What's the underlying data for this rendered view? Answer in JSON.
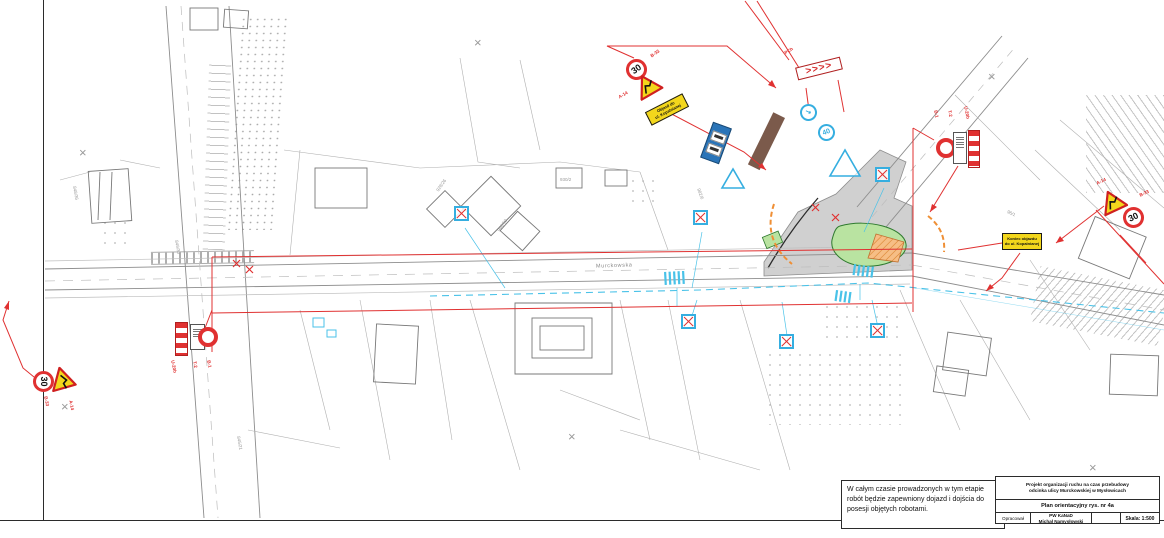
{
  "sheet": {
    "note": "W całym czasie prowadzonych w tym etapie robót będzie zapewniony dojazd i dojścia do posesji objętych robotami.",
    "title_block": {
      "project_title_line1": "Projekt organizacji ruchu na czas przebudowy",
      "project_title_line2": "odcinka ulicy Murckowskiej w Mysłowicach",
      "drawing_title": "Plan orientacyjny rys. nr 4a",
      "prepared_by_label": "Opracował",
      "prepared_by_line1": "PW KaNaD",
      "prepared_by_line2": "Michał Namysłowski",
      "scale": "Skala: 1:500"
    }
  },
  "street": {
    "name": "Murckowska"
  },
  "signs": {
    "speed_limit": "30",
    "zone_speed": "40",
    "keep_right_arrow": "↘",
    "chevrons": ">>>>",
    "labels": {
      "b33": "B-33",
      "a14": "A-14",
      "b1": "B-1",
      "t2": "T-2",
      "u20b": "U-20b",
      "pch": "PCh"
    },
    "detour_plate_line1": "Objazd do",
    "detour_plate_line2": "ul. Kopalnianej",
    "detour_end_line1": "Koniec objazdu",
    "detour_end_line2": "do ul. Kopalnianej"
  },
  "parcels": [
    "849/30",
    "848/36",
    "928/26",
    "960/50",
    "982/6",
    "845/21",
    "96/1",
    "930/2"
  ],
  "decor": {
    "cross_mark": "×"
  },
  "colors": {
    "new_signage_red": "#e03131",
    "existing_sign_blue": "#35aee0",
    "warning_yellow": "#f3d71c",
    "green_island": "#b9e3a1",
    "orange_works": "#f6be85",
    "brown_structure": "#7b5a4b",
    "linework_gray": "#8d8d8d"
  }
}
